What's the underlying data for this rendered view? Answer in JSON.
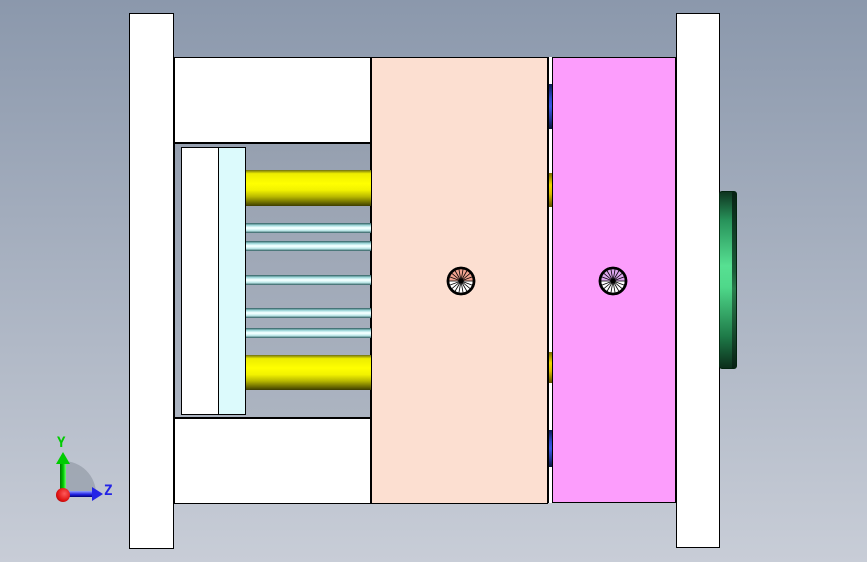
{
  "viewport": {
    "width_px": 867,
    "height_px": 562
  },
  "axis_triad": {
    "y_label": "Y",
    "z_label": "Z"
  },
  "colors": {
    "bg-top": "#8B98AC",
    "bg-bottom": "#C8CDD7",
    "outline": "#000000",
    "plate-white": "#FFFFFF",
    "cavity-peach": "#FCDFD1",
    "core-magenta": "#FC9DFC",
    "retainer-cyan": "#DCFAFC",
    "pin-yellow": "#FFFF00",
    "pin-olive": "#6E6E00",
    "pin-cyan-light": "#F2FFFF",
    "pin-cyan-dark": "#2F5B5E",
    "ring-green": "#57E092",
    "bushing-blue": "#3A5AE8",
    "gap-gold": "#F2D800",
    "screw1-fill": "#F0A28F",
    "screw2-fill": "#DEA6EE",
    "axis-green": "#00CC00",
    "axis-blue": "#2323E6",
    "axis-red": "#DD1111",
    "axis-arc": "#959DA9"
  }
}
